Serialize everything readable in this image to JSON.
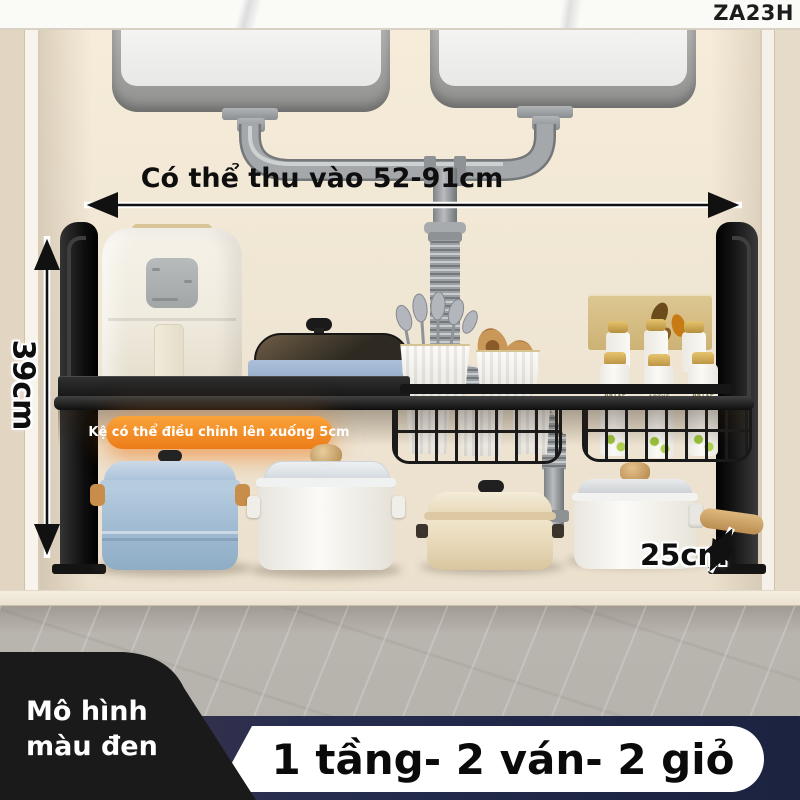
{
  "header": {
    "model_code": "ZA23H"
  },
  "annotations": {
    "width": "Có thể thu vào 52-91cm",
    "height": "39cm",
    "depth": "25cm",
    "badge": "Kệ có thể điều chỉnh lên xuống 5cm"
  },
  "products": {
    "bottle_brand": "ARTXE"
  },
  "footer": {
    "variant_line1": "Mô hình",
    "variant_line2": "màu đen",
    "banner": "1 tầng- 2 ván- 2 giỏ"
  },
  "colors": {
    "accent_orange": "#EE7E1C",
    "banner_navy": "#232A4C",
    "rack_black": "#191919",
    "wall_cream": "#EFE6D8",
    "pill_white": "#FFFFFF"
  }
}
